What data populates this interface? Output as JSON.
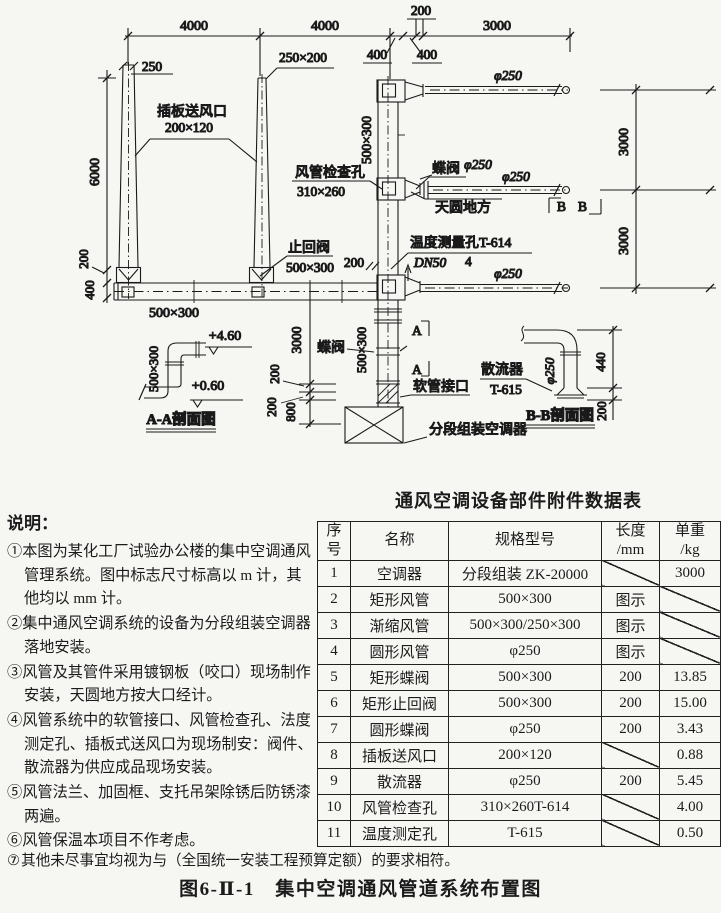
{
  "drawing": {
    "dims": {
      "top_4000a": "4000",
      "top_4000b": "4000",
      "top_200": "200",
      "top_400a": "400",
      "top_400b": "400",
      "top_3000": "3000",
      "riser1_250": "250",
      "riser2_250x200": "250×200",
      "left_6000": "6000",
      "left_200": "200",
      "left_400": "400",
      "duct_500x300": "500×300",
      "right_3000a": "3000",
      "right_3000b": "3000",
      "riser_500x300": "500×300",
      "valve_200": "200",
      "bl_3000": "3000",
      "bl_200a": "200",
      "bl_200b": "200",
      "bl_800": "800",
      "phi250_b1": "φ250",
      "phi250_b2": "φ250",
      "phi250_b3": "φ250",
      "aa_500x300": "500×300",
      "aa_elev_top": "+4.60",
      "aa_elev_bot": "+0.60",
      "bb_phi250": "φ250",
      "bb_440": "440",
      "bb_200": "200"
    },
    "labels": {
      "chaban1": "插板送风口",
      "chaban2": "200×120",
      "jiancha1": "风管检查孔",
      "jiancha2": "310×260",
      "zhihui1": "止回阀",
      "zhihui2": "500×300",
      "diefa_top": "蝶阀",
      "diefa_top_phi": "φ250",
      "tianyuan": "天圆地方",
      "wendu": "温度测量孔T-614",
      "dn50": "DN50",
      "dn50_qty": "4",
      "diefa_bottom": "蝶阀",
      "ruanguan": "软管接口",
      "fenduan": "分段组装空调器",
      "sanliuqi": "散流器",
      "t615": "T-615",
      "sec_b1": "B",
      "sec_b2": "B",
      "sec_a1": "A",
      "sec_a2": "A",
      "aa_title": "A-A剖面图",
      "bb_title": "B-B剖面图"
    }
  },
  "notes": {
    "title": "说明：",
    "bullets": [
      "①",
      "②",
      "③",
      "④",
      "⑤",
      "⑥"
    ],
    "items": [
      "本图为某化工厂试验办公楼的集中空调通风管理系统。图中标志尺寸标高以 m 计，其他均以 mm 计。",
      "集中通风空调系统的设备为分段组装空调器落地安装。",
      "风管及其管件采用镀钢板（咬口）现场制作安装，天圆地方按大口经计。",
      "风管系统中的软管接口、风管检查孔、法度测定孔、插板式送风口为现场制安：阀件、散流器为供应成品现场安装。",
      "风管法兰、加固框、支托吊架除锈后防锈漆两遍。",
      "风管保温本项目不作考虑。"
    ],
    "item7_bullet": "⑦",
    "item7": "其他未尽事宜均视为与（全国统一安装工程预算定额）的要求相符。"
  },
  "table": {
    "title": "通风空调设备部件附件数据表",
    "headers": {
      "no1": "序",
      "no2": "号",
      "name": "名称",
      "spec": "规格型号",
      "len1": "长度",
      "len2": "/mm",
      "wt1": "单重",
      "wt2": "/kg"
    },
    "rows": [
      {
        "no": "1",
        "name": "空调器",
        "spec": "分段组装 ZK-20000",
        "len": "",
        "wt": "3000"
      },
      {
        "no": "2",
        "name": "矩形风管",
        "spec": "500×300",
        "len": "图示",
        "wt": ""
      },
      {
        "no": "3",
        "name": "渐缩风管",
        "spec": "500×300/250×300",
        "len": "图示",
        "wt": ""
      },
      {
        "no": "4",
        "name": "圆形风管",
        "spec": "φ250",
        "len": "图示",
        "wt": ""
      },
      {
        "no": "5",
        "name": "矩形蝶阀",
        "spec": "500×300",
        "len": "200",
        "wt": "13.85"
      },
      {
        "no": "6",
        "name": "矩形止回阀",
        "spec": "500×300",
        "len": "200",
        "wt": "15.00"
      },
      {
        "no": "7",
        "name": "圆形蝶阀",
        "spec": "φ250",
        "len": "200",
        "wt": "3.43"
      },
      {
        "no": "8",
        "name": "插板送风口",
        "spec": "200×120",
        "len": "",
        "wt": "0.88"
      },
      {
        "no": "9",
        "name": "散流器",
        "spec": "φ250",
        "len": "200",
        "wt": "5.45"
      },
      {
        "no": "10",
        "name": "风管检查孔",
        "spec": "310×260T-614",
        "len": "",
        "wt": "4.00"
      },
      {
        "no": "11",
        "name": "温度测定孔",
        "spec": "T-615",
        "len": "",
        "wt": "0.50"
      }
    ]
  },
  "caption": "图6-Ⅱ-1　集中空调通风管道系统布置图"
}
